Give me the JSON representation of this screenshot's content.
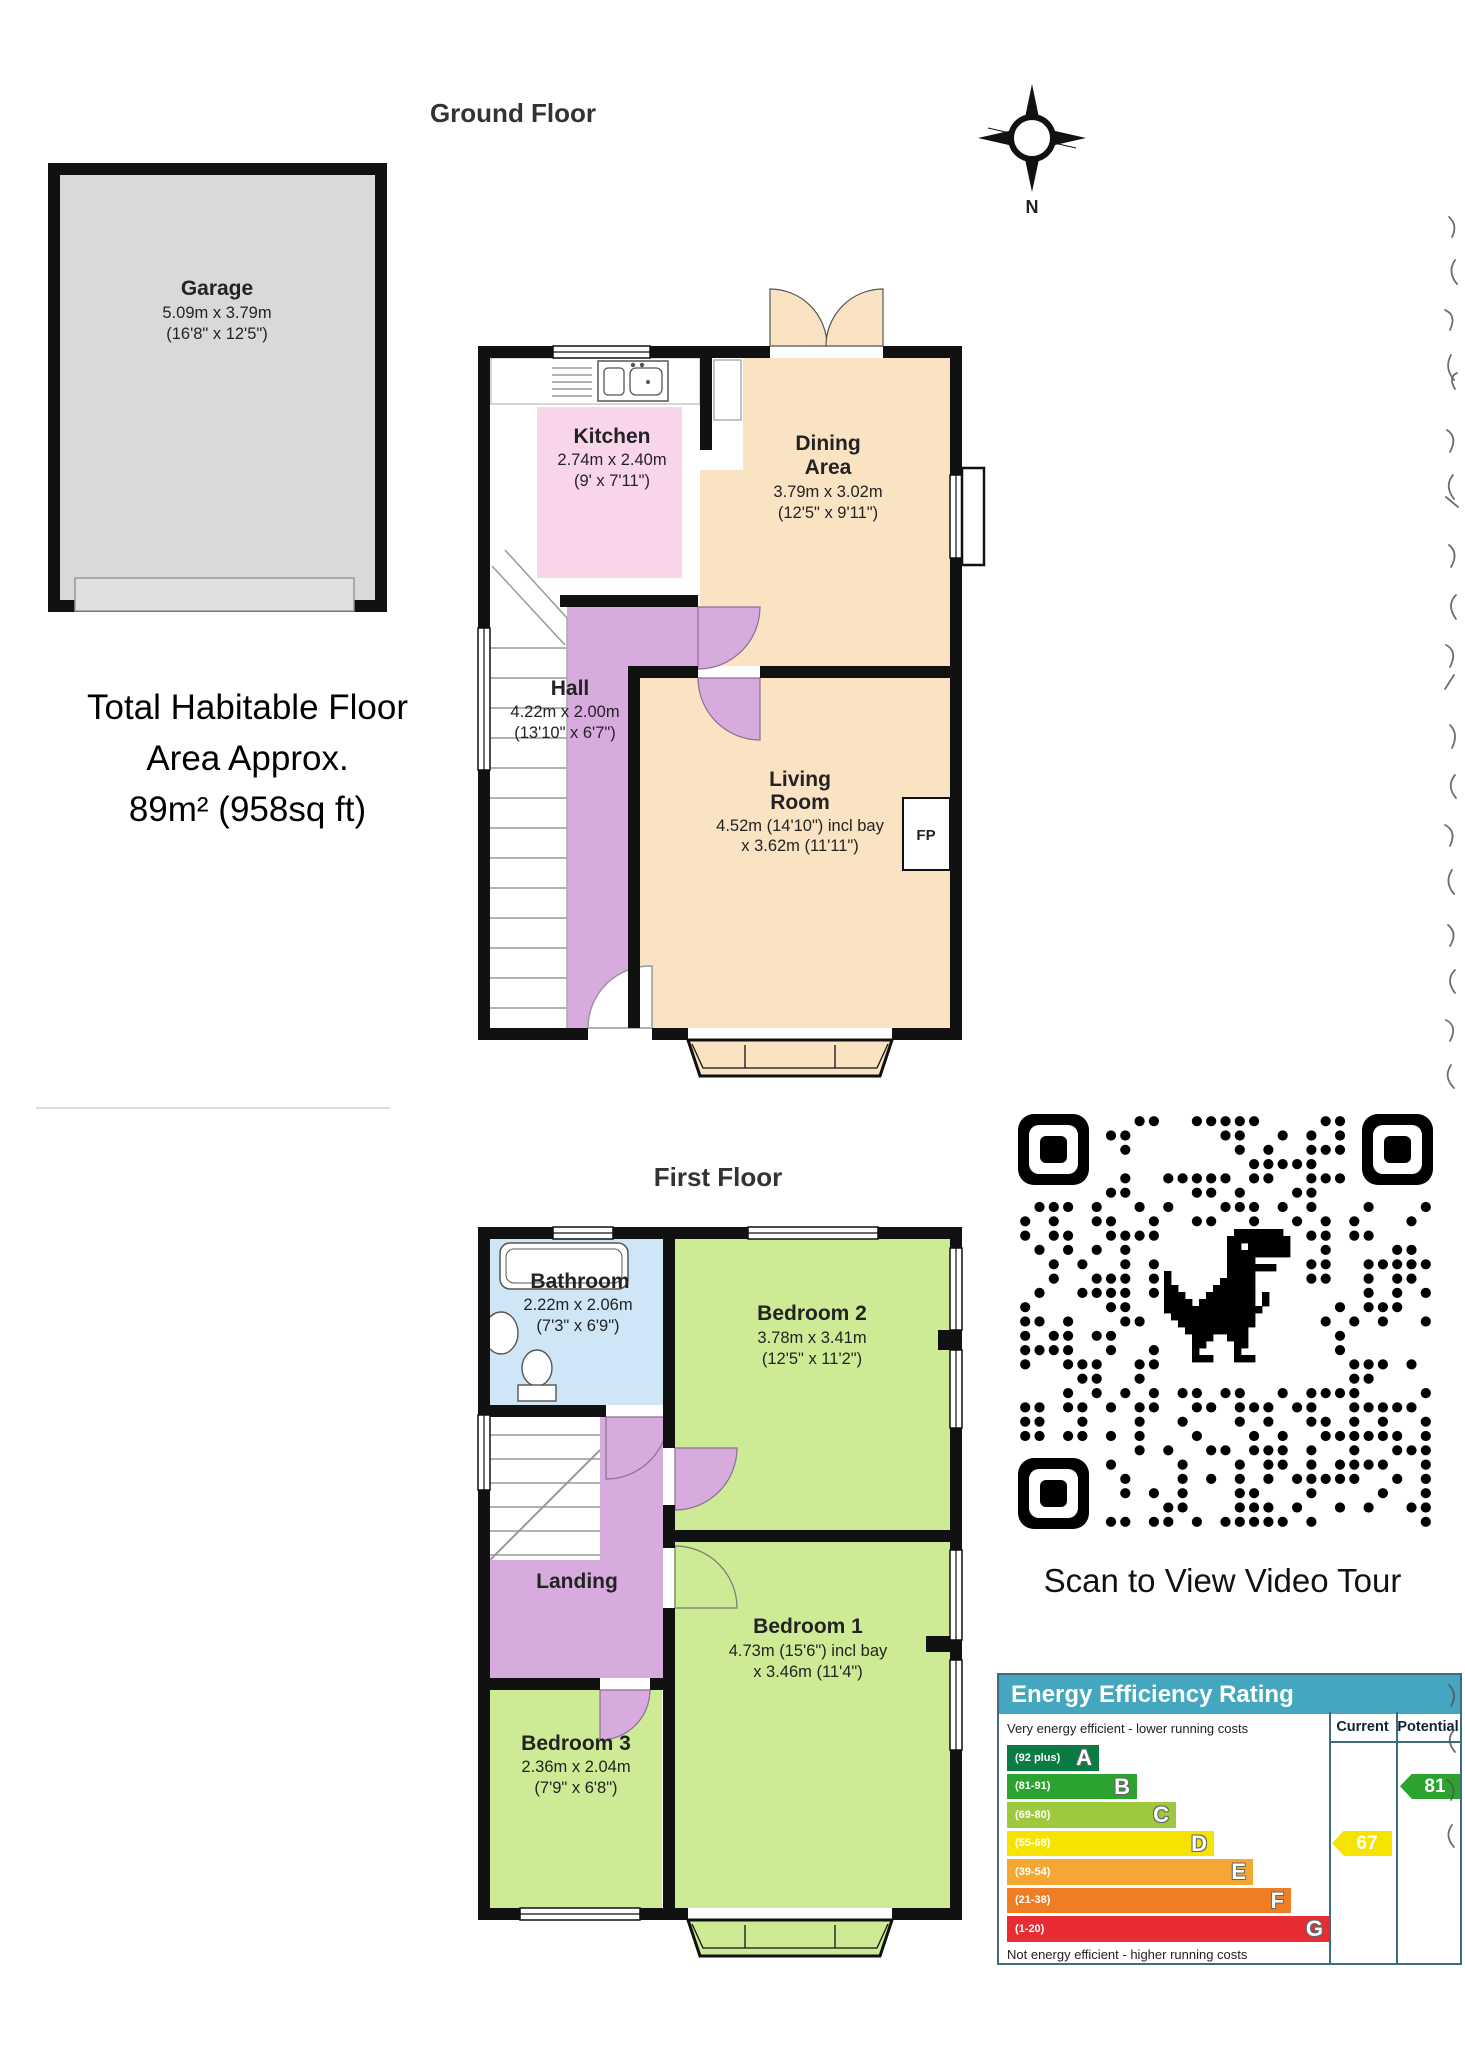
{
  "ground_floor": {
    "title": "Ground Floor",
    "compass": {
      "label": "N"
    },
    "garage": {
      "name": "Garage",
      "dims": "5.09m x 3.79m",
      "dims_ft": "(16'8\" x 12'5\")"
    },
    "kitchen": {
      "name": "Kitchen",
      "dims": "2.74m x 2.40m",
      "dims_ft": "(9' x 7'11\")"
    },
    "dining": {
      "name1": "Dining",
      "name2": "Area",
      "dims": "3.79m x 3.02m",
      "dims_ft": "(12'5\" x 9'11\")"
    },
    "hall": {
      "name": "Hall",
      "dims": "4.22m x 2.00m",
      "dims_ft": "(13'10\" x 6'7\")"
    },
    "living": {
      "name1": "Living",
      "name2": "Room",
      "dims": "4.52m (14'10\") incl bay",
      "dims2": "x 3.62m (11'11\")"
    },
    "fireplace_label": "FP",
    "total_area": {
      "line1": "Total Habitable Floor",
      "line2": "Area Approx.",
      "line3": "89m² (958sq ft)"
    }
  },
  "first_floor": {
    "title": "First Floor",
    "bathroom": {
      "name": "Bathroom",
      "dims": "2.22m x 2.06m",
      "dims_ft": "(7'3\" x 6'9\")"
    },
    "bedroom2": {
      "name": "Bedroom 2",
      "dims": "3.78m x 3.41m",
      "dims_ft": "(12'5\" x 11'2\")"
    },
    "landing": {
      "name": "Landing"
    },
    "bedroom1": {
      "name": "Bedroom 1",
      "dims": "4.73m (15'6\") incl bay",
      "dims2": "x 3.46m (11'4\")"
    },
    "bedroom3": {
      "name": "Bedroom 3",
      "dims": "2.36m x 2.04m",
      "dims_ft": "(7'9\" x 6'8\")"
    }
  },
  "qr": {
    "caption": "Scan to View Video Tour"
  },
  "chart_data": {
    "type": "bar",
    "title": "Energy Efficiency Rating",
    "top_note": "Very energy efficient - lower running costs",
    "bottom_note": "Not energy efficient - higher running costs",
    "columns": {
      "current": "Current",
      "potential": "Potential"
    },
    "bands": [
      {
        "letter": "A",
        "range": "(92 plus)",
        "color": "#0b7b44",
        "width": 92
      },
      {
        "letter": "B",
        "range": "(81-91)",
        "color": "#2ba32e",
        "width": 130
      },
      {
        "letter": "C",
        "range": "(69-80)",
        "color": "#9ec83e",
        "width": 169
      },
      {
        "letter": "D",
        "range": "(55-68)",
        "color": "#f7e300",
        "width": 207
      },
      {
        "letter": "E",
        "range": "(39-54)",
        "color": "#f4a732",
        "width": 246
      },
      {
        "letter": "F",
        "range": "(21-38)",
        "color": "#ee7d23",
        "width": 284
      },
      {
        "letter": "G",
        "range": "(1-20)",
        "color": "#e72d33",
        "width": 323
      }
    ],
    "current": {
      "value": "67",
      "band_index": 3,
      "color": "#f7e300"
    },
    "potential": {
      "value": "81",
      "band_index": 1,
      "color": "#2ba32e"
    }
  },
  "colors": {
    "wall": "#111111",
    "garage_fill": "#d9d9d9",
    "kitchen_fill": "#f8d5ea",
    "dining_fill": "#fae3c3",
    "hall_fill": "#d8abdf",
    "bedroom_fill": "#cdeb94",
    "bathroom_fill": "#cfe6f6",
    "epc_header": "#45a6bf"
  }
}
